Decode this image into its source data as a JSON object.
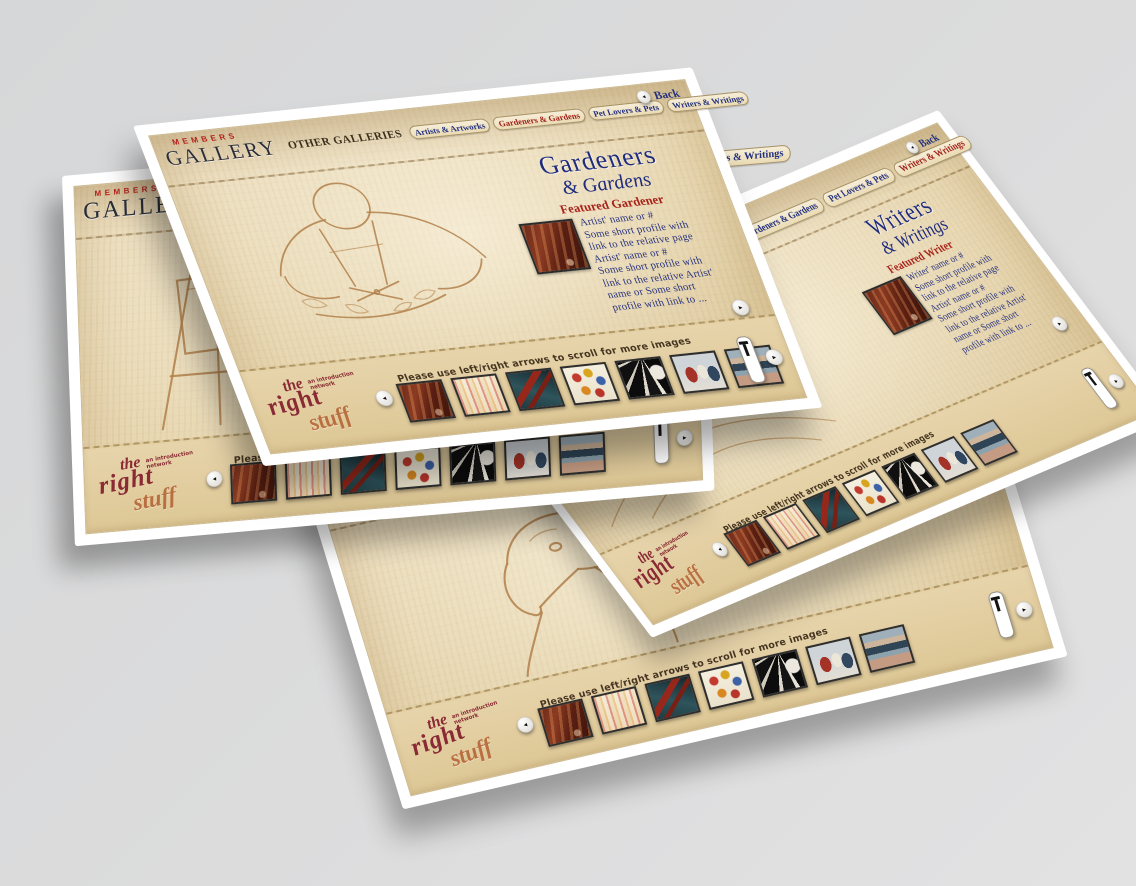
{
  "background_color": "#d9d9d9",
  "colors": {
    "accent_red": "#a8231b",
    "navy": "#22307e",
    "parchment": "#e6d5ae",
    "page_white": "#ffffff",
    "sketch_stroke": "#b2804a",
    "logo_maroon": "#8a2a34",
    "logo_tan": "#b96f3f",
    "brand_red": "#b3231d",
    "brand_dark": "#2a2d38"
  },
  "brand": {
    "members": "MEMBERS",
    "gallery": "GALLERY"
  },
  "back_label": "Back",
  "tabs": [
    "OTHER GALLERIES",
    "Artists & Artworks",
    "Gardeners & Gardens",
    "Pet Lovers & Pets",
    "Writers & Writings"
  ],
  "strip": {
    "caption": "Please use left/right arrows to scroll for more images",
    "logo": {
      "the": "the",
      "right": "right",
      "stuff": "stuff",
      "tagline": "an introduction network"
    },
    "left_arrow": "◂",
    "right_arrow": "▸",
    "thumbnails": [
      {
        "id": "canyon-figure-painting",
        "css": "t-canyon"
      },
      {
        "id": "crowd-scene-painting",
        "css": "t-crowd"
      },
      {
        "id": "red-shoes-painting",
        "css": "t-shoes"
      },
      {
        "id": "flower-abstract-painting",
        "css": "t-flowers"
      },
      {
        "id": "light-rays-painting",
        "css": "t-rays"
      },
      {
        "id": "figures-painting",
        "css": "t-figures"
      },
      {
        "id": "seascape-painting",
        "css": "t-seascape"
      }
    ]
  },
  "pages": [
    {
      "id": "pet-lovers-pets",
      "active_tab": null
    },
    {
      "id": "writers-writings",
      "active_tab": "Writers & Writings",
      "title_line1": "Writers",
      "title_line2": "& Writings",
      "featured_label": "Featured Writer",
      "profile_lines": [
        "Writer' name or #",
        "Some short profile with",
        "link to the relative page",
        "Artist' name or #",
        "Some short profile with",
        "link to the relative Artist'",
        "name or Some short",
        "profile with link to ..."
      ]
    },
    {
      "id": "other-galleries",
      "active_tab": "OTHER GALLERIES"
    },
    {
      "id": "gardeners-gardens",
      "active_tab": "Gardeners & Gardens",
      "title_line1": "Gardeners",
      "title_line2": "& Gardens",
      "featured_label": "Featured Gardener",
      "profile_lines": [
        "Artist' name or #",
        "Some short profile with",
        "link to the relative page",
        "Artist' name or #",
        "Some short profile with",
        "link to the relative Artist'",
        "name or Some short",
        "profile with link to ..."
      ]
    }
  ]
}
